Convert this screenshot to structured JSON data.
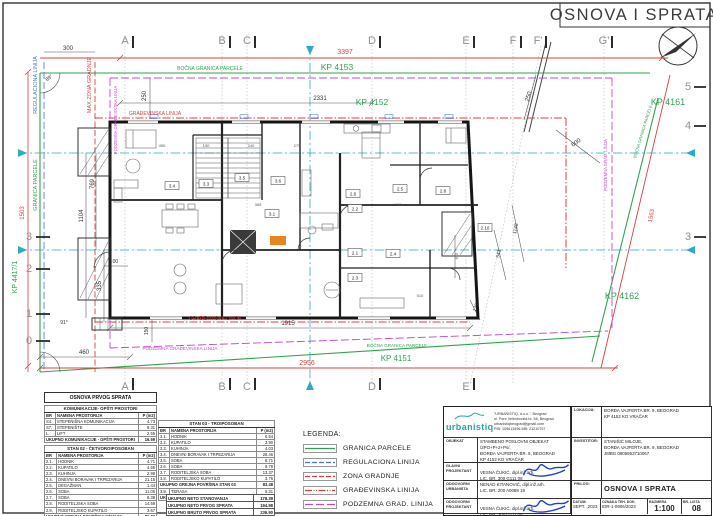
{
  "sheet": {
    "title": "OSNOVA I SPRATA"
  },
  "plan": {
    "grid": {
      "top": [
        "A",
        "B",
        "C",
        "D",
        "E",
        "F",
        "F'",
        "G'"
      ],
      "bottom": [
        "A",
        "B",
        "C",
        "D",
        "E"
      ],
      "left": [
        "3",
        "2",
        "1",
        "0"
      ],
      "right": [
        "5",
        "4",
        "3"
      ]
    },
    "kp": {
      "kp_4153": "KP 4153",
      "kp_4152": "KP 4152",
      "kp_4161": "KP 4161",
      "kp_4162": "KP 4162",
      "kp_4151": "KP 4151",
      "kp_4417": "KP 4417/1"
    },
    "lines": {
      "bocna": "BOČNA GRANICA PARCELE",
      "gradjevinska": "GRAĐEVINSKA LINIJA",
      "podzemna": "PODZEMNA GRAĐEVINSKA LINIJA",
      "podzemna_short": "PODZEMNA GRAĐ. LINIJA",
      "regulaciona": "REGULACIONA LINIJA",
      "granica": "GRANICA PARCELE",
      "max_zona": "MAX ZONA GRADNJE"
    },
    "dims": {
      "d3397": "3397",
      "d2331": "2331",
      "d300": "300",
      "d250a": "250",
      "d250b": "250",
      "d1503": "1503",
      "d1104": "1104",
      "d769": "769",
      "d335": "335",
      "d100": "100",
      "d460": "460",
      "d1915": "1915",
      "d150": "150",
      "d2956": "2956",
      "d600": "600",
      "d1148": "1148",
      "d541": "541",
      "d120": "120",
      "d1563": "1563",
      "a91": "91°",
      "a89": "89°",
      "d450": "450",
      "d130": "130",
      "d240": "240",
      "d275": "275",
      "d365": "365",
      "d160": "160",
      "d510": "510",
      "d615": "615"
    },
    "room_tags": [
      "3.4",
      "3.3",
      "3.5",
      "3.6",
      "3.1",
      "2.6",
      "2.5",
      "2.8",
      "2.2",
      "2.1",
      "2.4",
      "2.3",
      "2.10"
    ]
  },
  "legend": {
    "title": "LEGENDA:",
    "items": [
      {
        "label": "GRANICA PARCELE",
        "color": "#2fa34f",
        "style": "solid"
      },
      {
        "label": "REGULACIONA LINIJA",
        "color": "#4a6fd4",
        "style": "dashed"
      },
      {
        "label": "ZONA GRADNJE",
        "color": "#e03a3a",
        "style": "dashed"
      },
      {
        "label": "GRAĐEVINSKA LINIJA",
        "color": "#e03a3a",
        "style": "dashdotdot"
      },
      {
        "label": "PODZEMNA GRAD. LINIJA",
        "color": "#c44ac4",
        "style": "longdash"
      }
    ]
  },
  "area_tables": {
    "table1": {
      "title": "OSNOVA PRVOG SPRATA",
      "sections": [
        {
          "name": "KOMUNIKACIJE- OPŠTI PROSTORI",
          "headers": [
            "BR",
            "NAMENA PROSTORIJA",
            "P (m2)"
          ],
          "rows": [
            [
              "S4.",
              "STEPENIŠNA KOMUNIKACIJA",
              "4.73"
            ],
            [
              "S7.",
              "STEPENIŠTE",
              "9.31"
            ],
            [
              "L.",
              "LIFT",
              "2.55"
            ],
            [
              "",
              "UKUPNO KOMUNIKACIJE - OPŠTI PROSTORI",
              "16.59"
            ]
          ]
        },
        {
          "name": "STAN 02 - ČETVOROIPOSOBAN",
          "headers": [
            "BR",
            "NAMENA PROSTORIJA",
            "P (m2)"
          ],
          "rows": [
            [
              "2.1.",
              "HODNIK",
              "4.71"
            ],
            [
              "2.2.",
              "KUPATILO",
              "4.66"
            ],
            [
              "2.3.",
              "KUHINJA",
              "2.98"
            ],
            [
              "2.4.",
              "DNEVNI BORAVAK I TRPEZARIJA",
              "21.15"
            ],
            [
              "2.5.",
              "DEGAŽMAN",
              "1.44"
            ],
            [
              "2.6.",
              "SOBA",
              "11.05"
            ],
            [
              "2.7.",
              "SOBA",
              "8.38"
            ],
            [
              "2.8.",
              "RODITELJSKA SOBA",
              "14.59"
            ],
            [
              "2.9.",
              "RODITELJSKO KUPATILO",
              "3.67"
            ],
            [
              "",
              "UKUPNO GREJNA POVRŠINA STAN 02",
              "86.02"
            ],
            [
              "2.10.",
              "TERASA",
              "5.22"
            ],
            [
              "",
              "UKUPNO NETO POVRŠINA STAN 02",
              "91.24"
            ]
          ]
        }
      ]
    },
    "table2": {
      "title": "STAN 03 - TROIPOSOBAN",
      "headers": [
        "BR",
        "NAMENA PROSTORIJA",
        "P (m2)"
      ],
      "rows": [
        [
          "3.1.",
          "HODNIK",
          "6.54"
        ],
        [
          "3.2.",
          "KUPATILO",
          "3.90"
        ],
        [
          "3.3.",
          "KUHINJA",
          "4.03"
        ],
        [
          "3.4.",
          "DNEVNI BORAVAK I TRPEZARIJA",
          "28.46"
        ],
        [
          "3.5.",
          "SOBA",
          "8.71"
        ],
        [
          "3.6.",
          "SOBA",
          "9.78"
        ],
        [
          "3.7.",
          "RODITELJSKA SOBA",
          "13.37"
        ],
        [
          "3.8.",
          "RODITELJSKO KUPATILO",
          "3.76"
        ],
        [
          "",
          "UKUPNO GREJNA POVRŠINA STAN 03",
          "83.48"
        ],
        [
          "3.9.",
          "TERASA",
          "5.31"
        ],
        [
          "",
          "UKUPNO NETO POVRŠINA STAN 03",
          "87.06"
        ]
      ]
    },
    "summary": {
      "rows": [
        [
          "UKUPNO NETO STANOVANJA",
          "178.39"
        ],
        [
          "UKUPNO NETO PRVOG SPRATA",
          "194.98"
        ],
        [
          "UKUPNO BRUTO PRVOG SPRATA",
          "236.90"
        ]
      ]
    }
  },
  "titleblock": {
    "company": {
      "logo": "urbanistiq",
      "line1": "\"URBANISTIQ, d.o.o.\", Beograd",
      "line2": "ul. Pere Velimirovića br. 58, Beograd",
      "line3": "urbanistiqbeograd@gmail.com",
      "line4": "PIB: 109613496  MB: 21210757"
    },
    "objekat_label": "OBJEKAT",
    "objekat_value": "STAMBENO POSLOVNI OBJEKAT /2PO+P+2+Ps/,\nĐORĐA VAJFERTA BR. 9, BEOGRAD\nKP 4152 KO VRAČAR",
    "glavni_label": "GLAVNI\nPROJEKTANT",
    "glavni_value": "VESNA ČUKIĆ, dipl.inž.arh.\nLIC. BR. 300 G111 08",
    "urbanista_label": "ODGOVORNI\nURBANISTA",
    "urbanista_value": "NENAD KITANOVIĆ, dipl.inž.arh.\nLIC. BR. 200 A0088 19",
    "odgovorni_label": "ODGOVORNI\nPROJEKTANT",
    "odgovorni_value": "VESNA ČUKIĆ, dipl.inž.arh.\nLIC. BR. 300 G111 08",
    "lokacija_label": "LOKACIJA:",
    "lokacija_value": "ĐORĐA VAJFERTA BR. 9, BEOGRAD\nKP 4152 KO VRAČAR",
    "investitor_label": "INVESTITOR:",
    "investitor_value": "STANIŠIĆ MILOJE,\nĐORĐA VAJFERTA BR. 9, BEOGRAD\nJMBG 0905953710067",
    "prilog_label": "PRILOG:",
    "prilog_value": "OSNOVA I SPRATA",
    "datum_label": "DATUM:",
    "datum_value": "SEPT. ,2023",
    "oznaka_label": "OZNAKA TEH. DOK.",
    "oznaka_value": "IDR-1-0906/2023",
    "razmera_label": "RAZMERA",
    "razmera_value": "1:100",
    "lista_label": "BR. LISTA",
    "lista_value": "08"
  }
}
